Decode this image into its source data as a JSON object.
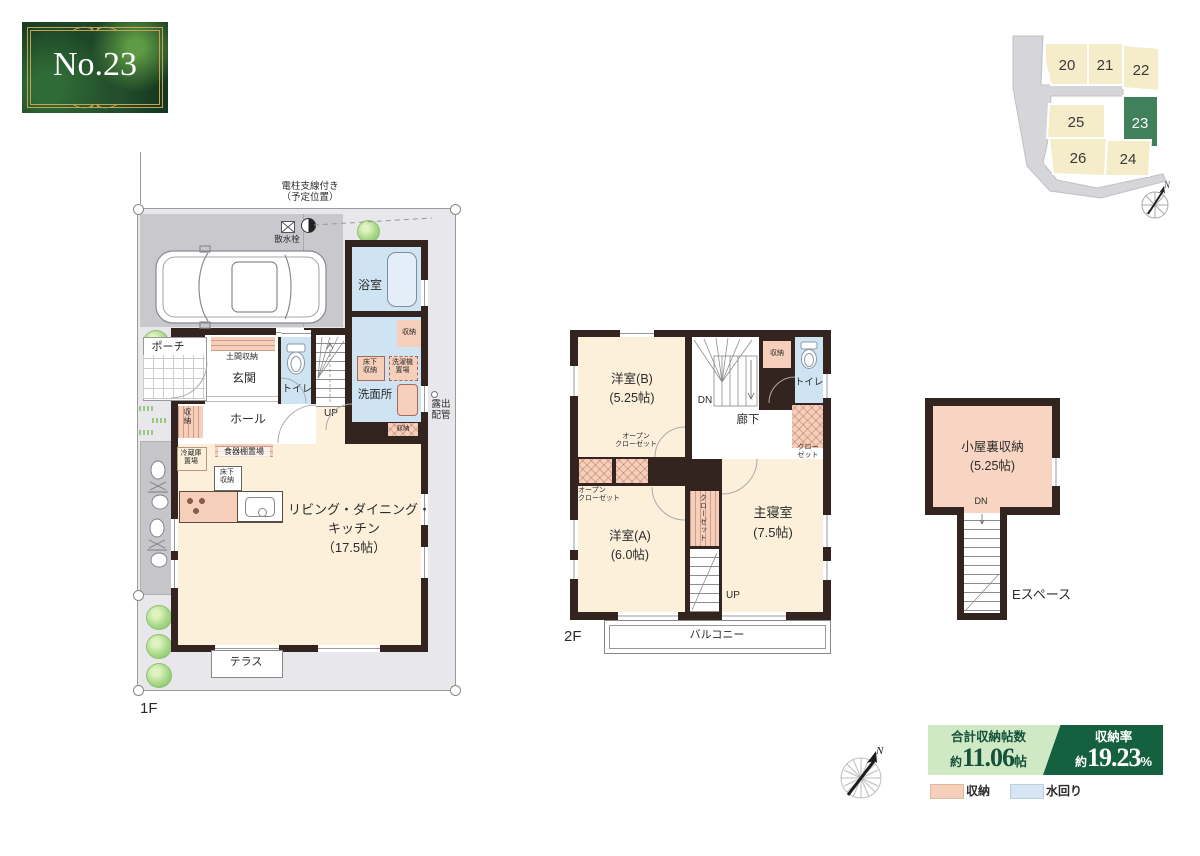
{
  "badge": {
    "number": "No.23"
  },
  "sitemap": {
    "lot20": "20",
    "lot21": "21",
    "lot22": "22",
    "lot23": "23",
    "lot24": "24",
    "lot25": "25",
    "lot26": "26"
  },
  "compass": {
    "n": "N"
  },
  "common": {
    "storage": "収納",
    "toilet": "トイレ",
    "up": "UP",
    "dn": "DN",
    "yukashita_1": "床下",
    "yukashita_2": "収納",
    "open_closet_1": "オープン",
    "open_closet_2": "クローゼット",
    "closet_1": "クロー",
    "closet_2": "ゼット",
    "size_525": "(5.25帖)"
  },
  "f1": {
    "floor_label": "1F",
    "pole_1": "電柱支線付き",
    "pole_2": "（予定位置）",
    "sprinkler": "散水栓",
    "bath": "浴室",
    "porch": "ポーチ",
    "doma": "土間収納",
    "entrance": "玄関",
    "hall": "ホール",
    "washer_1": "洗濯機",
    "washer_2": "置場",
    "washroom": "洗面所",
    "pipe_1": "露出",
    "pipe_2": "配管",
    "fridge_1": "冷蔵庫",
    "fridge_2": "置場",
    "cupboard": "食器棚置場",
    "ldk_1": "リビング・ダイニング・",
    "ldk_2": "キッチン",
    "ldk_3": "（17.5帖）",
    "terrace": "テラス"
  },
  "f2": {
    "floor_label": "2F",
    "room_b": "洋室(B)",
    "room_a": "洋室(A)",
    "room_a_size": "(6.0帖)",
    "corridor": "廊下",
    "closet_v": "クローゼット",
    "master": "主寝室",
    "master_size": "(7.5帖)",
    "balcony": "バルコニー"
  },
  "attic": {
    "name": "小屋裏収納",
    "espace": "Eスペース"
  },
  "stats": {
    "total_title": "合計収納帖数",
    "approx": "約",
    "total_value": "11.06",
    "total_unit": "帖",
    "rate_title": "収納率",
    "rate_value": "19.23",
    "rate_unit": "%"
  },
  "legend": {
    "storage": "収納",
    "water": "水回り"
  },
  "colors": {
    "storage_pink": "#f6cfba",
    "water_blue": "#cfe4f3",
    "room_cream": "#fcf0da",
    "wall": "#33241f",
    "lot_green": "#40805a",
    "banner_light": "#cfe9c5",
    "banner_dark": "#14603f"
  }
}
